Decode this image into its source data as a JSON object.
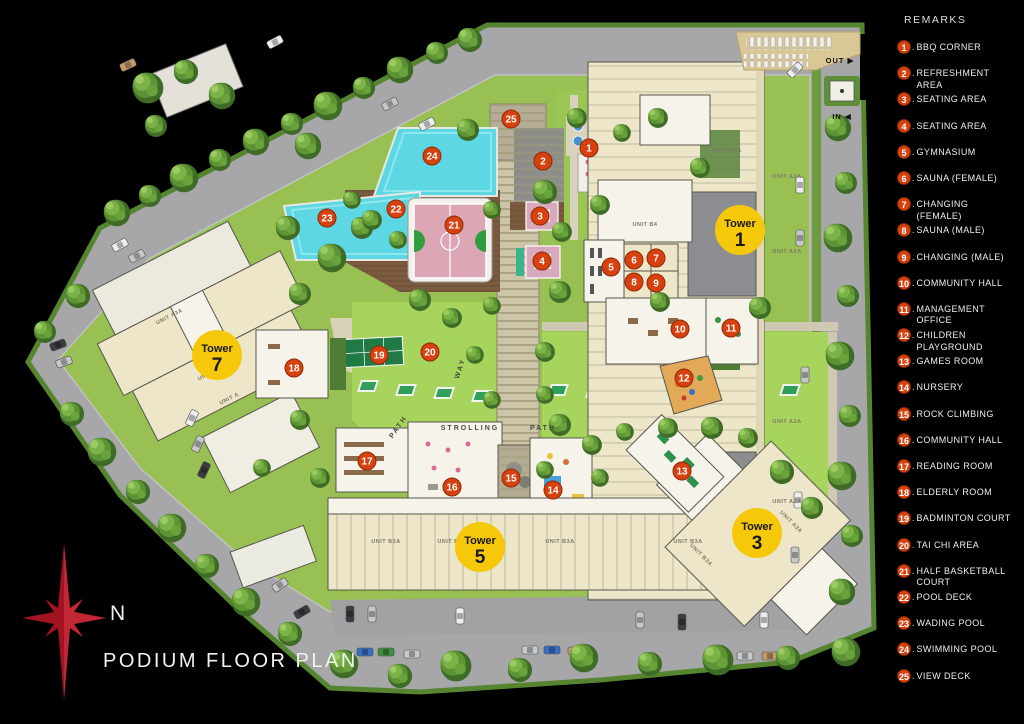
{
  "title": "Podium Floor Plan",
  "compass": {
    "label": "N"
  },
  "colors": {
    "marker": "#d6410f",
    "marker_rim": "#8f2a06",
    "tower": "#f6c80a",
    "pool": "#5ed7e4",
    "court": "#dca6b5",
    "lawn": "#a6d45c",
    "road": "#a7a7a9"
  },
  "legend": {
    "header": "Remarks",
    "items": [
      {
        "num": "1",
        "label": "Bbq Corner"
      },
      {
        "num": "2",
        "label": "Refreshment Area"
      },
      {
        "num": "3",
        "label": "Seating area"
      },
      {
        "num": "4",
        "label": "Seating Area"
      },
      {
        "num": "5",
        "label": "Gymnasium"
      },
      {
        "num": "6",
        "label": "Sauna (Female)"
      },
      {
        "num": "7",
        "label": "Changing (Female)"
      },
      {
        "num": "8",
        "label": "Sauna (Male)"
      },
      {
        "num": "9",
        "label": "Changing (Male)"
      },
      {
        "num": "10",
        "label": "Community Hall"
      },
      {
        "num": "11",
        "label": "Management Office"
      },
      {
        "num": "12",
        "label": "Children Playground"
      },
      {
        "num": "13",
        "label": "Games Room"
      },
      {
        "num": "14",
        "label": "Nursery"
      },
      {
        "num": "15",
        "label": "Rock Climbing"
      },
      {
        "num": "16",
        "label": "Community Hall"
      },
      {
        "num": "17",
        "label": "Reading Room"
      },
      {
        "num": "18",
        "label": "Elderly Room"
      },
      {
        "num": "19",
        "label": "Badminton Court"
      },
      {
        "num": "20",
        "label": "Tai Chi Area"
      },
      {
        "num": "21",
        "label": "Half Basketball Court"
      },
      {
        "num": "22",
        "label": "Pool Deck"
      },
      {
        "num": "23",
        "label": "Wading Pool"
      },
      {
        "num": "24",
        "label": "Swimming Pool"
      },
      {
        "num": "25",
        "label": "View Deck"
      }
    ]
  },
  "towers": [
    {
      "prefix": "Tower",
      "num": "1",
      "x": 740,
      "y": 230
    },
    {
      "prefix": "Tower",
      "num": "3",
      "x": 757,
      "y": 533
    },
    {
      "prefix": "Tower",
      "num": "5",
      "x": 480,
      "y": 547
    },
    {
      "prefix": "Tower",
      "num": "7",
      "x": 217,
      "y": 355
    }
  ],
  "markers": [
    {
      "num": "1",
      "x": 589,
      "y": 148
    },
    {
      "num": "2",
      "x": 543,
      "y": 161
    },
    {
      "num": "3",
      "x": 540,
      "y": 216
    },
    {
      "num": "4",
      "x": 542,
      "y": 261
    },
    {
      "num": "5",
      "x": 611,
      "y": 267
    },
    {
      "num": "6",
      "x": 634,
      "y": 260
    },
    {
      "num": "7",
      "x": 656,
      "y": 258
    },
    {
      "num": "8",
      "x": 634,
      "y": 282
    },
    {
      "num": "9",
      "x": 656,
      "y": 283
    },
    {
      "num": "10",
      "x": 680,
      "y": 329
    },
    {
      "num": "11",
      "x": 731,
      "y": 328
    },
    {
      "num": "12",
      "x": 684,
      "y": 378
    },
    {
      "num": "13",
      "x": 682,
      "y": 471
    },
    {
      "num": "14",
      "x": 553,
      "y": 490
    },
    {
      "num": "15",
      "x": 511,
      "y": 478
    },
    {
      "num": "16",
      "x": 452,
      "y": 487
    },
    {
      "num": "17",
      "x": 367,
      "y": 461
    },
    {
      "num": "18",
      "x": 294,
      "y": 368
    },
    {
      "num": "19",
      "x": 379,
      "y": 355
    },
    {
      "num": "20",
      "x": 430,
      "y": 352
    },
    {
      "num": "21",
      "x": 454,
      "y": 225
    },
    {
      "num": "22",
      "x": 396,
      "y": 209
    },
    {
      "num": "23",
      "x": 327,
      "y": 218
    },
    {
      "num": "24",
      "x": 432,
      "y": 156
    },
    {
      "num": "25",
      "x": 511,
      "y": 119
    }
  ],
  "map_labels": [
    {
      "text": "STROLLING",
      "x": 470,
      "y": 430,
      "rot": 0,
      "size": 7,
      "color": "#4a4a42",
      "ls": 2
    },
    {
      "text": "PATH",
      "x": 543,
      "y": 430,
      "rot": 0,
      "size": 7,
      "color": "#4a4a42",
      "ls": 2
    },
    {
      "text": "PATH",
      "x": 400,
      "y": 428,
      "rot": -55,
      "size": 7,
      "color": "#4a4a42",
      "ls": 2
    },
    {
      "text": "WAY",
      "x": 462,
      "y": 369,
      "rot": -72,
      "size": 7,
      "color": "#4a4a42",
      "ls": 2
    },
    {
      "text": "OUT ▶",
      "x": 840,
      "y": 63,
      "rot": 0,
      "size": 7.5,
      "color": "#111111",
      "ls": 1
    },
    {
      "text": "IN ◀",
      "x": 842,
      "y": 119,
      "rot": 0,
      "size": 7.5,
      "color": "#111111",
      "ls": 1
    }
  ],
  "unit_labels": [
    {
      "text": "UNIT A2A",
      "x": 727,
      "y": 152,
      "rot": 0
    },
    {
      "text": "UNIT A2A",
      "x": 787,
      "y": 178,
      "rot": 0
    },
    {
      "text": "UNIT A2A",
      "x": 787,
      "y": 253,
      "rot": 0
    },
    {
      "text": "UNIT A2A",
      "x": 787,
      "y": 423,
      "rot": 0
    },
    {
      "text": "UNIT A2A",
      "x": 787,
      "y": 503,
      "rot": 0
    },
    {
      "text": "UNIT B4",
      "x": 645,
      "y": 226,
      "rot": 0
    },
    {
      "text": "UNIT A3A",
      "x": 170,
      "y": 318,
      "rot": -27
    },
    {
      "text": "UNIT B3A",
      "x": 212,
      "y": 374,
      "rot": -27
    },
    {
      "text": "UNIT A",
      "x": 230,
      "y": 400,
      "rot": -27
    },
    {
      "text": "UNIT B3A",
      "x": 386,
      "y": 543,
      "rot": 0
    },
    {
      "text": "UNIT B3A",
      "x": 452,
      "y": 543,
      "rot": 0
    },
    {
      "text": "UNIT B3A",
      "x": 560,
      "y": 543,
      "rot": 0
    },
    {
      "text": "UNIT B3A",
      "x": 688,
      "y": 543,
      "rot": 0
    },
    {
      "text": "UNIT A3A",
      "x": 790,
      "y": 523,
      "rot": 45
    },
    {
      "text": "UNIT B3A",
      "x": 700,
      "y": 556,
      "rot": 45
    }
  ]
}
